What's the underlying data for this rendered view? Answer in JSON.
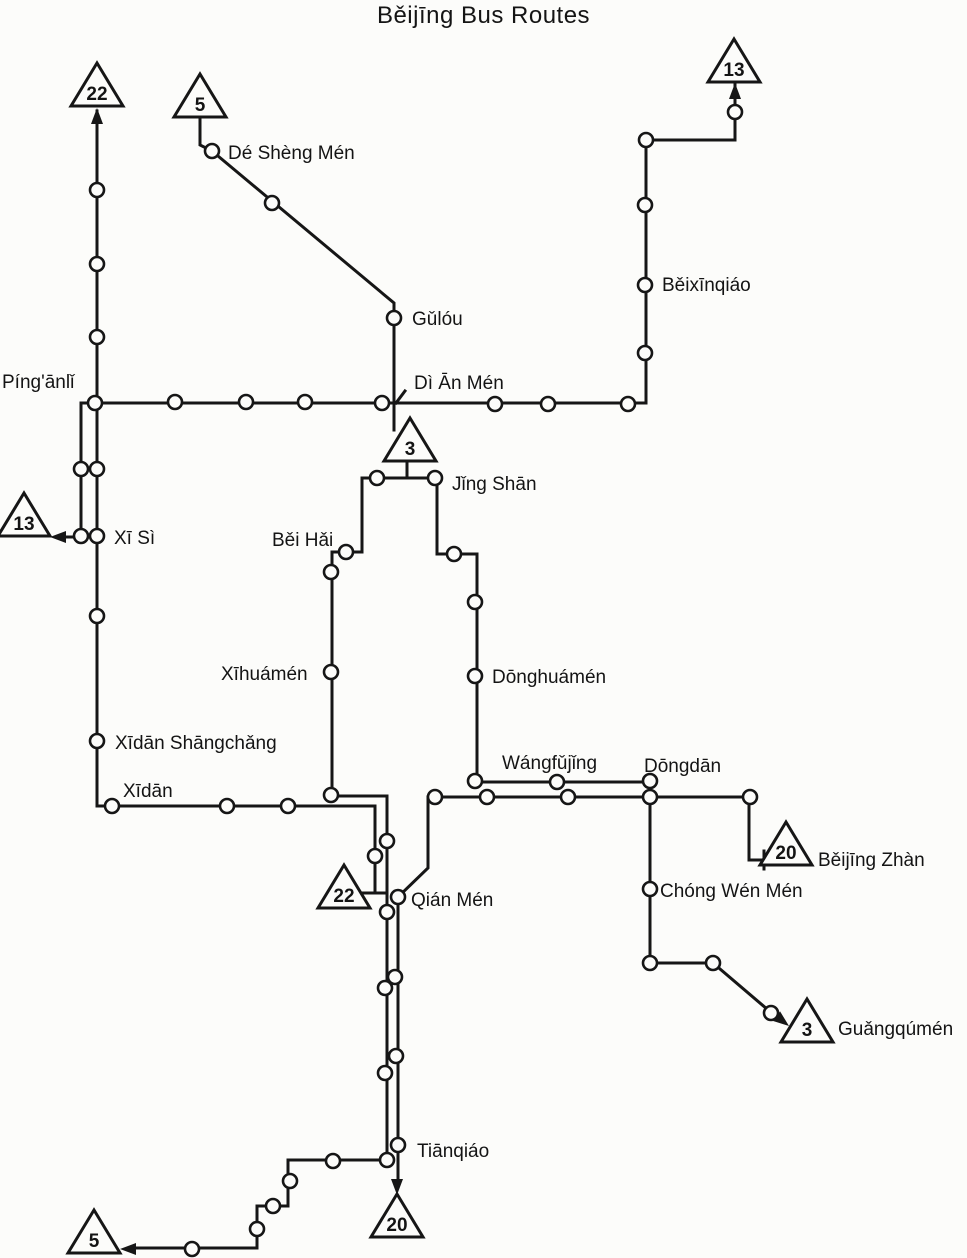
{
  "title": "Běijīng Bus Routes",
  "map": {
    "width": 967,
    "height": 1258,
    "ink": "#161616",
    "bg": "#fcfcfa",
    "line_width": 3,
    "station_radius": 7,
    "station_stroke": 2.6
  },
  "routes": [
    {
      "number": "22",
      "segments": [
        [
          [
            97,
            111
          ],
          [
            97,
            806
          ],
          [
            375,
            806
          ],
          [
            375,
            891
          ]
        ]
      ]
    },
    {
      "number": "13",
      "segments": [
        [
          [
            735,
            85
          ],
          [
            735,
            140
          ],
          [
            646,
            140
          ],
          [
            646,
            403
          ],
          [
            81,
            403
          ],
          [
            81,
            537
          ],
          [
            63,
            537
          ]
        ]
      ]
    },
    {
      "number": "5",
      "segments": [
        [
          [
            200,
            118
          ],
          [
            200,
            145
          ],
          [
            212,
            151
          ],
          [
            394,
            303
          ],
          [
            394,
            430
          ]
        ],
        [
          [
            362,
            478
          ],
          [
            362,
            552
          ],
          [
            332,
            552
          ],
          [
            332,
            796
          ],
          [
            387,
            796
          ],
          [
            387,
            1160
          ],
          [
            288,
            1160
          ],
          [
            288,
            1206
          ],
          [
            257,
            1206
          ],
          [
            257,
            1248
          ],
          [
            133,
            1248
          ]
        ]
      ]
    },
    {
      "number": "3",
      "segments": [
        [
          [
            407,
            461
          ],
          [
            407,
            478
          ]
        ],
        [
          [
            362,
            478
          ],
          [
            437,
            478
          ]
        ],
        [
          [
            437,
            478
          ],
          [
            437,
            554
          ],
          [
            477,
            554
          ],
          [
            477,
            782
          ],
          [
            650,
            782
          ],
          [
            650,
            963
          ],
          [
            713,
            963
          ],
          [
            774,
            1015
          ]
        ]
      ]
    },
    {
      "number": "20",
      "segments": [
        [
          [
            766,
            860
          ],
          [
            749,
            860
          ],
          [
            749,
            797
          ],
          [
            428,
            797
          ],
          [
            428,
            868
          ],
          [
            398,
            897
          ],
          [
            398,
            1181
          ]
        ]
      ]
    }
  ],
  "marks": [
    {
      "id": "route-22-terminus-bar",
      "points": [
        [
          363,
          893
        ],
        [
          387,
          893
        ]
      ]
    },
    {
      "id": "beijing-zhan-terminus-tick",
      "points": [
        [
          764,
          851
        ],
        [
          764,
          869
        ]
      ]
    },
    {
      "id": "di-an-men-leader",
      "points": [
        [
          405,
          391
        ],
        [
          396,
          403
        ]
      ]
    }
  ],
  "triangles": [
    {
      "route": "22",
      "x": 97,
      "y": 86,
      "id": "22-north"
    },
    {
      "route": "5",
      "x": 200,
      "y": 97,
      "id": "5-north"
    },
    {
      "route": "13",
      "x": 734,
      "y": 62,
      "id": "13-northeast"
    },
    {
      "route": "13",
      "x": 24,
      "y": 516,
      "id": "13-west"
    },
    {
      "route": "3",
      "x": 410,
      "y": 441,
      "id": "3-central"
    },
    {
      "route": "22",
      "x": 344,
      "y": 888,
      "id": "22-south"
    },
    {
      "route": "20",
      "x": 786,
      "y": 845,
      "id": "20-beijing-zhan"
    },
    {
      "route": "3",
      "x": 807,
      "y": 1022,
      "id": "3-guangqumen"
    },
    {
      "route": "20",
      "x": 397,
      "y": 1217,
      "id": "20-south"
    },
    {
      "route": "5",
      "x": 94,
      "y": 1233,
      "id": "5-south"
    }
  ],
  "arrows": [
    {
      "id": "route-22-north",
      "x": 97,
      "y": 108,
      "angle": -90
    },
    {
      "id": "route-13-north",
      "x": 735,
      "y": 83,
      "angle": -90
    },
    {
      "id": "route-13-west",
      "x": 50,
      "y": 537,
      "angle": 180
    },
    {
      "id": "route-20-south",
      "x": 397,
      "y": 1195,
      "angle": 90
    },
    {
      "id": "route-5-south",
      "x": 120,
      "y": 1249,
      "angle": 180
    },
    {
      "id": "route-3-southeast",
      "x": 789,
      "y": 1026,
      "angle": 38
    }
  ],
  "stations": [
    {
      "x": 97,
      "y": 190
    },
    {
      "x": 97,
      "y": 264
    },
    {
      "x": 97,
      "y": 337
    },
    {
      "x": 95,
      "y": 403,
      "id": "pinganli",
      "name": "Píng'ānlǐ"
    },
    {
      "x": 97,
      "y": 469
    },
    {
      "x": 81,
      "y": 469
    },
    {
      "x": 97,
      "y": 536,
      "id": "xi-si",
      "name": "Xī Sì"
    },
    {
      "x": 81,
      "y": 536
    },
    {
      "x": 97,
      "y": 616
    },
    {
      "x": 97,
      "y": 741,
      "id": "xidan-shangchang",
      "name": "Xīdān Shāngchǎng"
    },
    {
      "x": 112,
      "y": 806,
      "id": "xidan",
      "name": "Xīdān"
    },
    {
      "x": 227,
      "y": 806
    },
    {
      "x": 288,
      "y": 806
    },
    {
      "x": 375,
      "y": 856
    },
    {
      "x": 735,
      "y": 112
    },
    {
      "x": 646,
      "y": 140
    },
    {
      "x": 645,
      "y": 205
    },
    {
      "x": 645,
      "y": 285,
      "id": "beixinqiao",
      "name": "Běixīnqiáo"
    },
    {
      "x": 645,
      "y": 353
    },
    {
      "x": 628,
      "y": 404
    },
    {
      "x": 548,
      "y": 404
    },
    {
      "x": 495,
      "y": 404
    },
    {
      "x": 382,
      "y": 403,
      "id": "di-an-men",
      "name": "Dì Ān Mén"
    },
    {
      "x": 305,
      "y": 402
    },
    {
      "x": 246,
      "y": 402
    },
    {
      "x": 175,
      "y": 402
    },
    {
      "x": 212,
      "y": 151,
      "id": "de-sheng-men",
      "name": "Dé Shèng Mén"
    },
    {
      "x": 272,
      "y": 203
    },
    {
      "x": 394,
      "y": 318,
      "id": "gulou",
      "name": "Gǔlóu"
    },
    {
      "x": 377,
      "y": 478
    },
    {
      "x": 435,
      "y": 478,
      "id": "jing-shan",
      "name": "Jǐng Shān"
    },
    {
      "x": 346,
      "y": 552,
      "id": "bei-hai",
      "name": "Běi Hǎi"
    },
    {
      "x": 331,
      "y": 572
    },
    {
      "x": 331,
      "y": 672,
      "id": "xihuamen",
      "name": "Xīhuámén"
    },
    {
      "x": 331,
      "y": 795
    },
    {
      "x": 387,
      "y": 841
    },
    {
      "x": 387,
      "y": 912
    },
    {
      "x": 385,
      "y": 988
    },
    {
      "x": 385,
      "y": 1073
    },
    {
      "x": 387,
      "y": 1160
    },
    {
      "x": 333,
      "y": 1161
    },
    {
      "x": 290,
      "y": 1181
    },
    {
      "x": 273,
      "y": 1206
    },
    {
      "x": 257,
      "y": 1229
    },
    {
      "x": 192,
      "y": 1249
    },
    {
      "x": 454,
      "y": 554
    },
    {
      "x": 475,
      "y": 602
    },
    {
      "x": 475,
      "y": 676,
      "id": "donghuamen",
      "name": "Dōnghuámén"
    },
    {
      "x": 475,
      "y": 781
    },
    {
      "x": 557,
      "y": 782,
      "id": "wangfujing",
      "name": "Wángfǔjǐng"
    },
    {
      "x": 650,
      "y": 781,
      "id": "dongdan",
      "name": "Dōngdān"
    },
    {
      "x": 650,
      "y": 797
    },
    {
      "x": 650,
      "y": 889,
      "id": "chong-wen-men",
      "name": "Chóng Wén Mén"
    },
    {
      "x": 650,
      "y": 963
    },
    {
      "x": 713,
      "y": 963
    },
    {
      "x": 771,
      "y": 1013
    },
    {
      "x": 750,
      "y": 797
    },
    {
      "x": 568,
      "y": 797
    },
    {
      "x": 487,
      "y": 797
    },
    {
      "x": 435,
      "y": 797
    },
    {
      "x": 398,
      "y": 897,
      "id": "qian-men",
      "name": "Qián Mén"
    },
    {
      "x": 395,
      "y": 977
    },
    {
      "x": 396,
      "y": 1056
    },
    {
      "x": 398,
      "y": 1145,
      "id": "tianqiao",
      "name": "Tiānqiáo"
    }
  ],
  "labels": [
    {
      "text": "Dé Shèng Mén",
      "x": 228,
      "y": 159,
      "for": "de-sheng-men"
    },
    {
      "text": "Gǔlóu",
      "x": 412,
      "y": 325,
      "for": "gulou"
    },
    {
      "text": "Dì Ān Mén",
      "x": 414,
      "y": 389,
      "for": "di-an-men"
    },
    {
      "text": "Běixīnqiáo",
      "x": 662,
      "y": 291,
      "for": "beixinqiao"
    },
    {
      "text": "Píng'ānlǐ",
      "x": 2,
      "y": 388,
      "for": "pinganli"
    },
    {
      "text": "Xī Sì",
      "x": 114,
      "y": 544,
      "for": "xi-si"
    },
    {
      "text": "Jǐng Shān",
      "x": 452,
      "y": 490,
      "for": "jing-shan"
    },
    {
      "text": "Běi Hǎi",
      "x": 272,
      "y": 546,
      "for": "bei-hai"
    },
    {
      "text": "Xīhuámén",
      "x": 221,
      "y": 680,
      "for": "xihuamen"
    },
    {
      "text": "Dōnghuámén",
      "x": 492,
      "y": 683,
      "for": "donghuamen"
    },
    {
      "text": "Xīdān Shāngchǎng",
      "x": 115,
      "y": 749,
      "for": "xidan-shangchang"
    },
    {
      "text": "Xīdān",
      "x": 123,
      "y": 797,
      "for": "xidan"
    },
    {
      "text": "Wángfǔjǐng",
      "x": 502,
      "y": 769,
      "for": "wangfujing"
    },
    {
      "text": "Dōngdān",
      "x": 644,
      "y": 772,
      "for": "dongdan"
    },
    {
      "text": "Běijīng Zhàn",
      "x": 818,
      "y": 866,
      "for": "beijing-zhan"
    },
    {
      "text": "Chóng Wén Mén",
      "x": 660,
      "y": 897,
      "for": "chong-wen-men"
    },
    {
      "text": "Guǎngqúmén",
      "x": 838,
      "y": 1035,
      "for": "guangqumen"
    },
    {
      "text": "Qián Mén",
      "x": 411,
      "y": 906,
      "for": "qian-men"
    },
    {
      "text": "Tiānqiáo",
      "x": 417,
      "y": 1157,
      "for": "tianqiao"
    }
  ]
}
